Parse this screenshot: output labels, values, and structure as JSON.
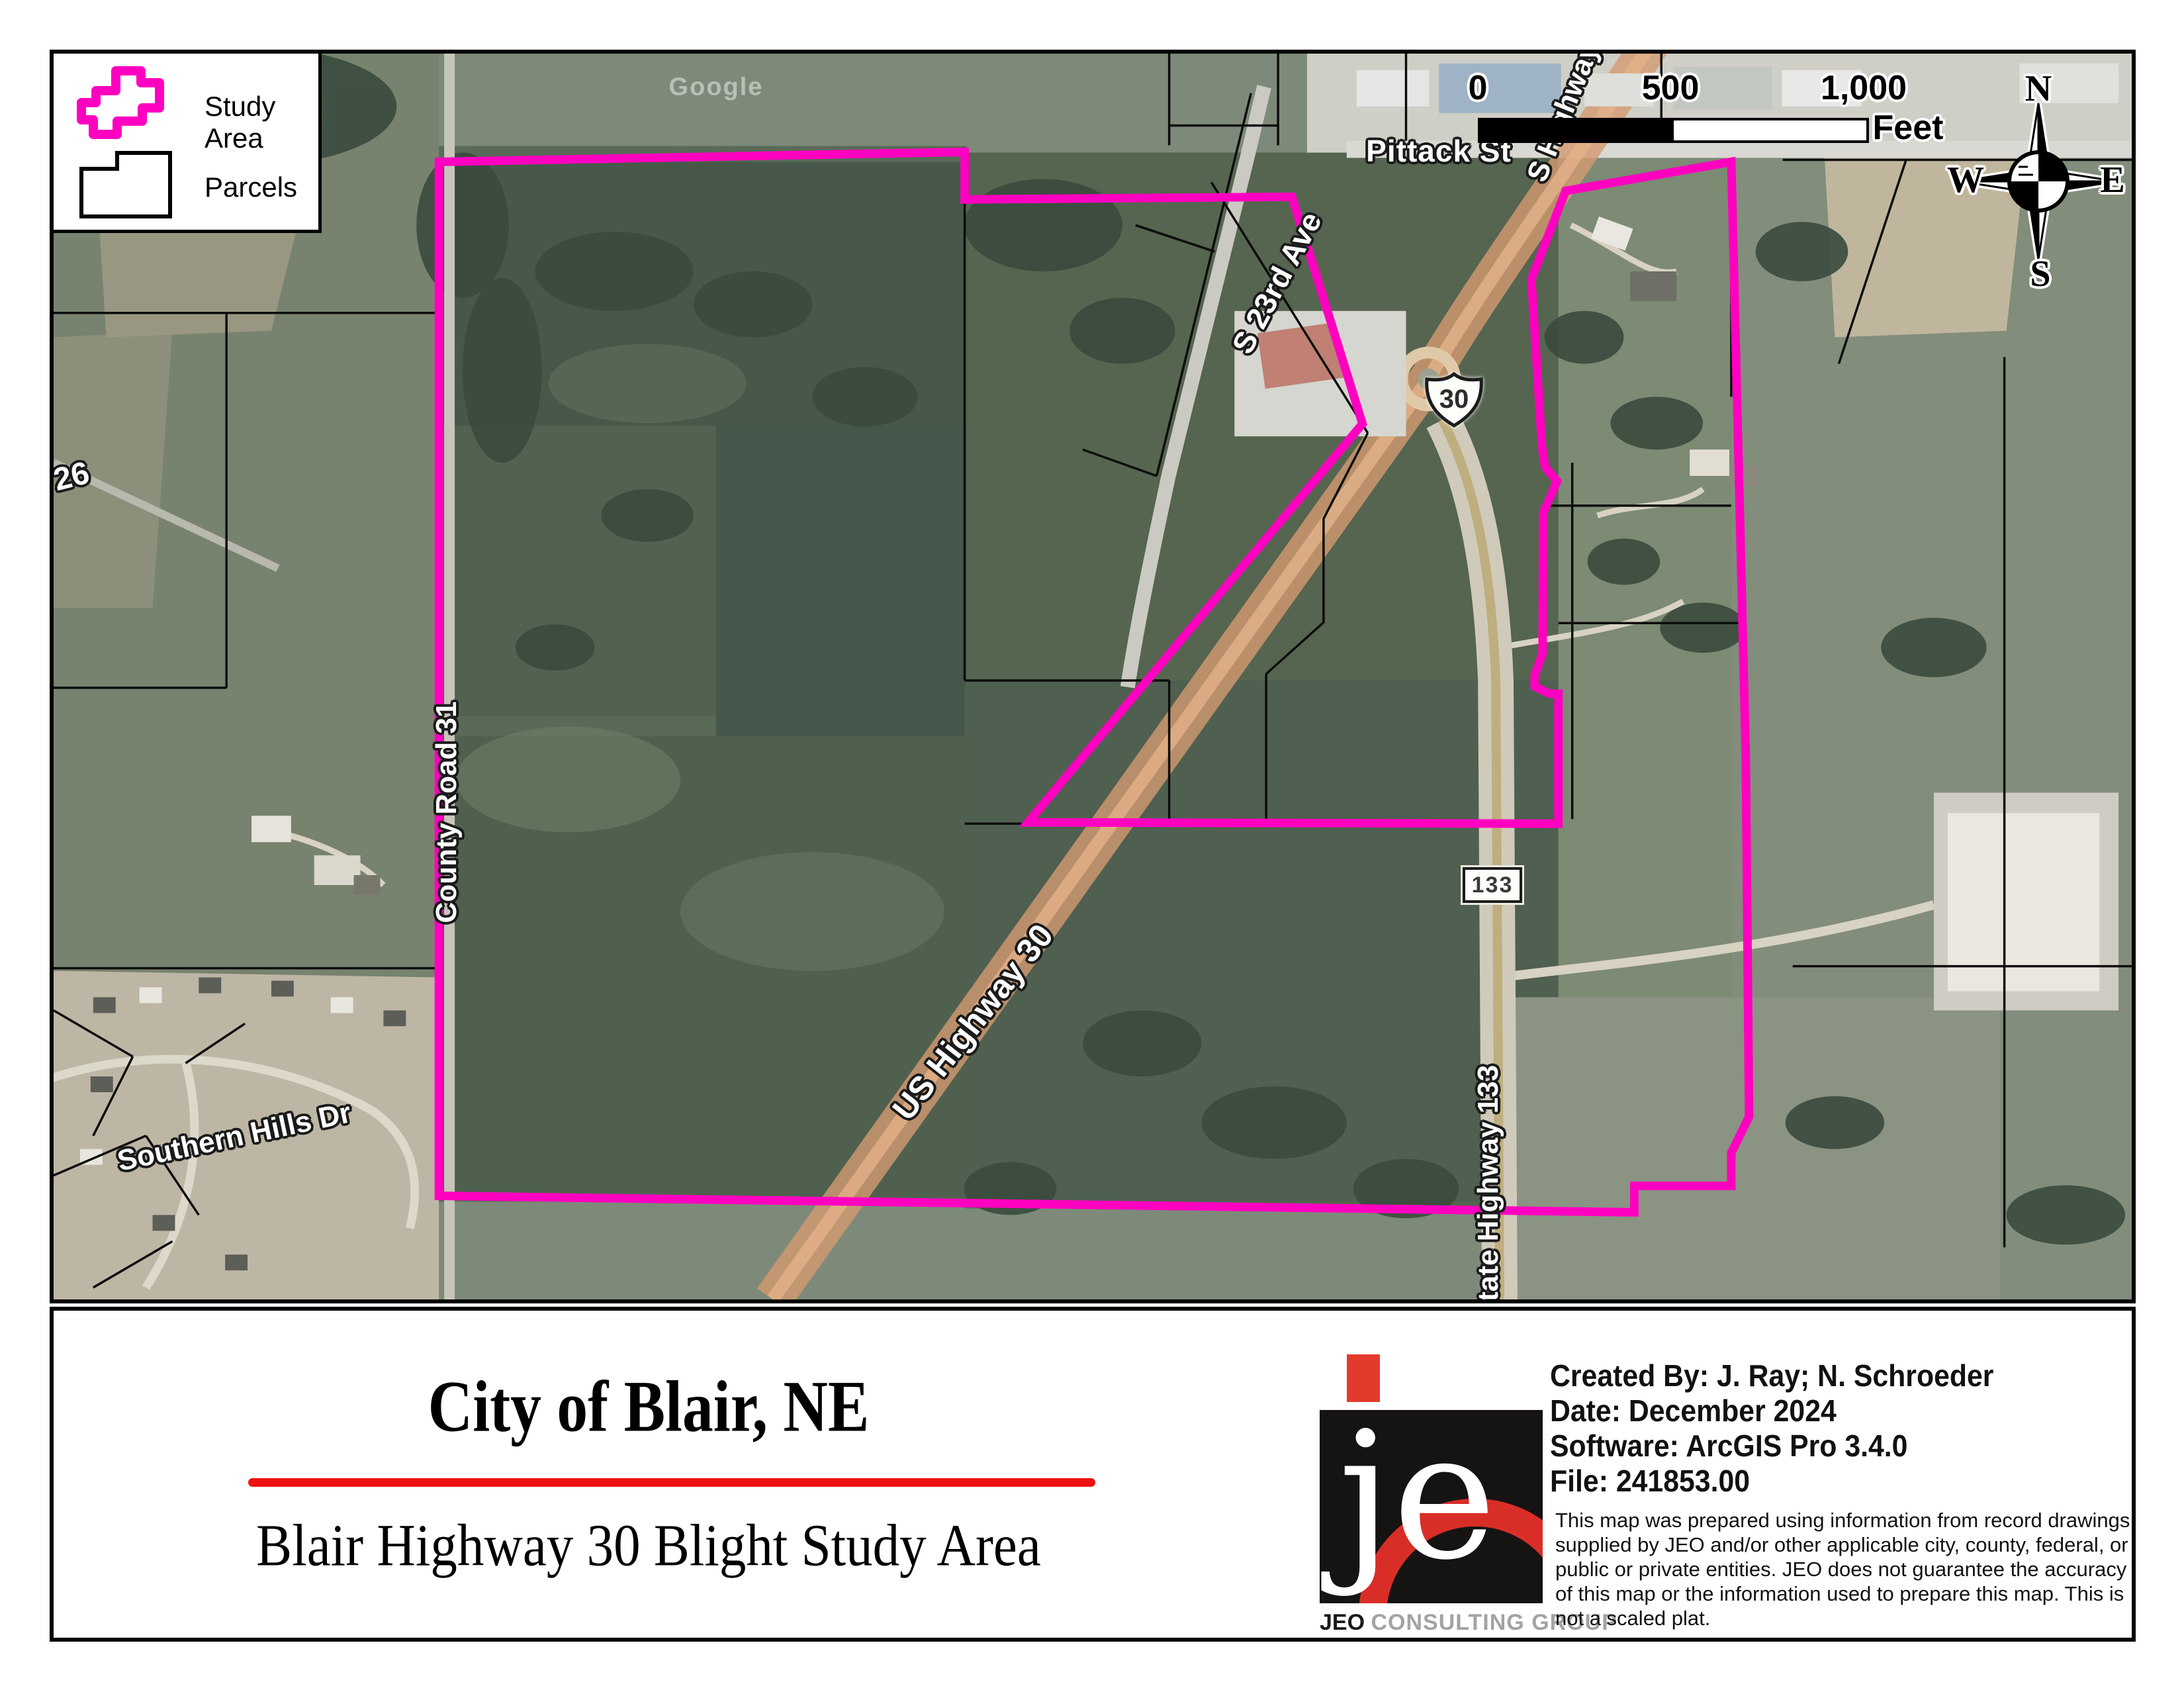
{
  "legend": {
    "study_area_label": "Study Area",
    "parcels_label": "Parcels"
  },
  "scale_bar": {
    "ticks": [
      "0",
      "500",
      "1,000"
    ],
    "unit": "Feet"
  },
  "compass": {
    "n": "N",
    "e": "E",
    "s": "S",
    "w": "W"
  },
  "map_labels": [
    {
      "text": "Pittack St"
    },
    {
      "text": "S 23rd Ave"
    },
    {
      "text": "US Highway 30"
    },
    {
      "text": "State Highway 133"
    },
    {
      "text": "County Road 31"
    },
    {
      "text": "Southern Hills Dr"
    },
    {
      "text": "26"
    },
    {
      "text": "S Highway 30"
    }
  ],
  "shields": {
    "us30": "30",
    "sh133": "133"
  },
  "watermark": "Google",
  "title_block": {
    "city": "City of Blair, NE",
    "subtitle": "Blair Highway 30 Blight Study Area"
  },
  "logo": {
    "name": "JEO",
    "tagline": "CONSULTING GROUP"
  },
  "credits": {
    "created_by": "Created By: J. Ray; N. Schroeder",
    "date": "Date: December 2024",
    "software": "Software: ArcGIS Pro 3.4.0",
    "file": "File: 241853.00"
  },
  "disclaimer": "This map was prepared using information from record drawings supplied by JEO and/or other applicable city, county, federal, or public or private entities. JEO does not guarantee the accuracy of this map or the information used to prepare this map. This is not a scaled plat.",
  "colors": {
    "study_area": "#FF00C0",
    "accent_red": "#EE1111",
    "logo_red": "#E23B2E"
  }
}
